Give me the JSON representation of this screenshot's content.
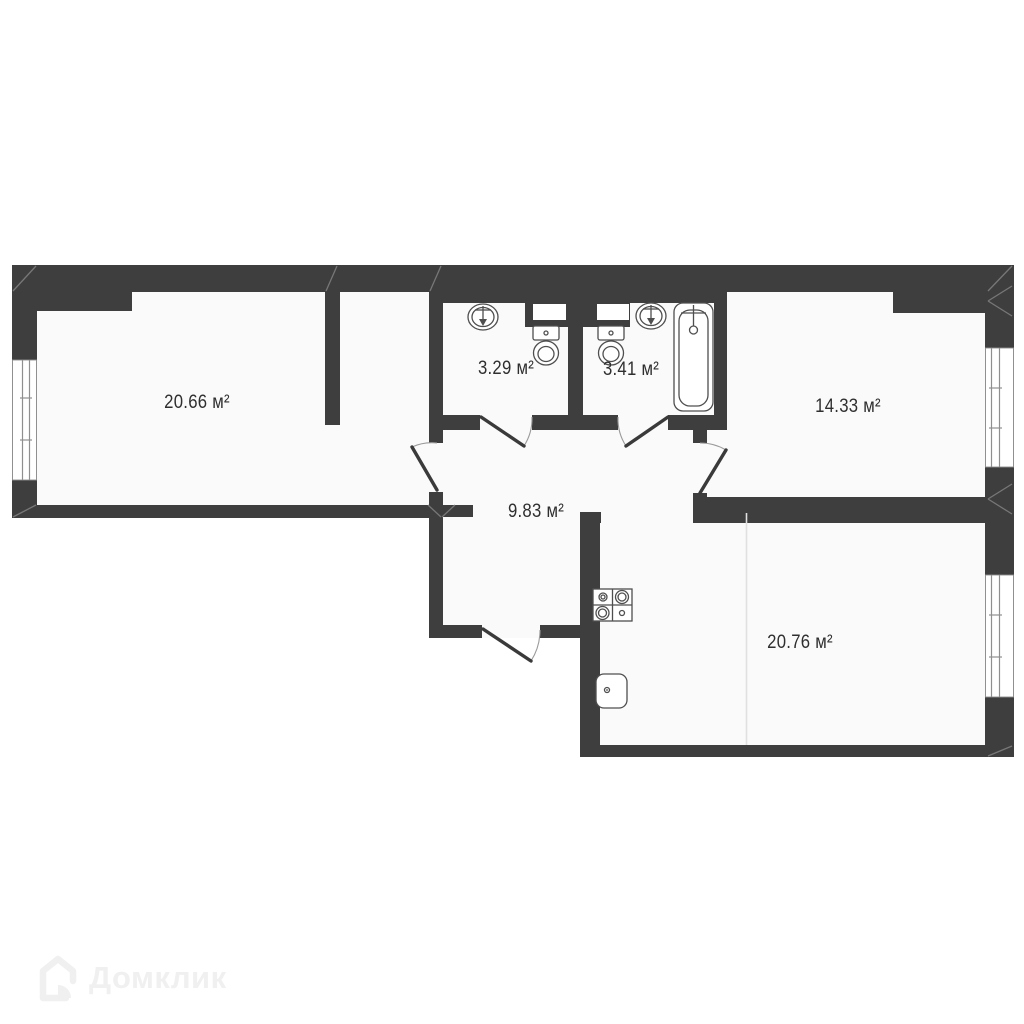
{
  "document": {
    "kind": "apartment floor plan",
    "background_color": "#ffffff",
    "wall_color": "#3e3e3e",
    "room_fill_color": "#fafafa",
    "label_color": "#2f2f2f",
    "watermark_color": "#f0f0f0"
  },
  "rooms": [
    {
      "id": "room-large-left",
      "area_label": "20.66 м²"
    },
    {
      "id": "bathroom-1",
      "area_label": "3.29 м²"
    },
    {
      "id": "bathroom-2",
      "area_label": "3.41 м²"
    },
    {
      "id": "room-right-top",
      "area_label": "14.33 м²"
    },
    {
      "id": "hallway",
      "area_label": "9.83 м²"
    },
    {
      "id": "kitchen-living",
      "area_label": "20.76 м²"
    }
  ],
  "fixtures": [
    {
      "icon": "sink-icon",
      "room": "bathroom-1"
    },
    {
      "icon": "toilet-icon",
      "room": "bathroom-1"
    },
    {
      "icon": "sink-icon",
      "room": "bathroom-2"
    },
    {
      "icon": "toilet-icon",
      "room": "bathroom-2"
    },
    {
      "icon": "bathtub-icon",
      "room": "bathroom-2"
    },
    {
      "icon": "stove-icon",
      "room": "kitchen-living"
    },
    {
      "icon": "kitchen-sink-icon",
      "room": "kitchen-living"
    }
  ],
  "windows": [
    {
      "icon": "window",
      "wall": "left"
    },
    {
      "icon": "window",
      "wall": "right-upper"
    },
    {
      "icon": "window",
      "wall": "right-lower"
    }
  ],
  "doors": [
    {
      "icon": "door-swing",
      "between": "entry-strip / hallway"
    },
    {
      "icon": "door-swing",
      "between": "bathroom-1 / hallway"
    },
    {
      "icon": "door-swing",
      "between": "bathroom-2 / hallway"
    },
    {
      "icon": "door-swing",
      "between": "hallway / room-right-top"
    },
    {
      "icon": "door-swing",
      "between": "hallway / outside"
    }
  ],
  "watermark": {
    "text": "Домклик",
    "icon": "domclick-house-icon"
  }
}
